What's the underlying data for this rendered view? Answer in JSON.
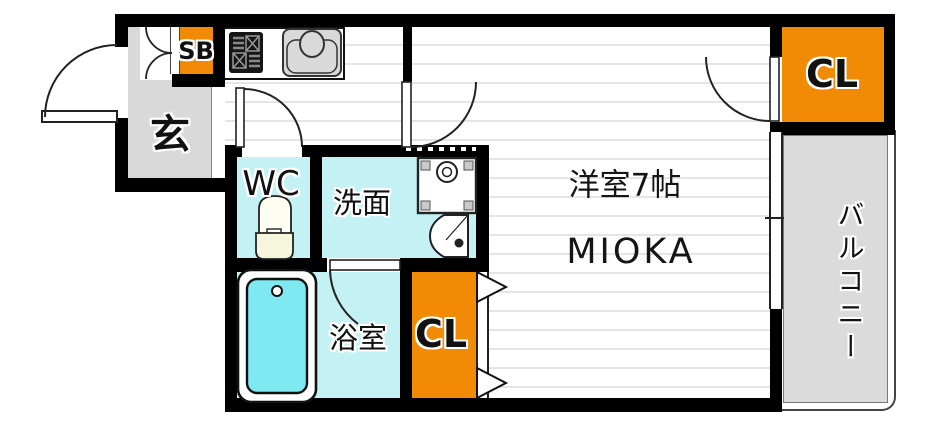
{
  "plan": {
    "building_name": "MIOKA",
    "rooms": {
      "genkan": {
        "label": "玄"
      },
      "shoe_box": {
        "label": "SB"
      },
      "wc": {
        "label": "WC"
      },
      "washroom": {
        "label": "洗面"
      },
      "bathroom": {
        "label": "浴室"
      },
      "closet_lower": {
        "label": "CL"
      },
      "closet_upper": {
        "label": "CL"
      },
      "western_room": {
        "label": "洋室7帖"
      },
      "balcony": {
        "label": "バルコニー"
      }
    },
    "fixtures": [
      "entrance-door-icon",
      "shoe-box-double-door-icon",
      "gas-stove-icon",
      "kitchen-sink-icon",
      "wc-door-icon",
      "toilet-icon",
      "room-door-icon",
      "washing-machine-pan-icon",
      "vanity-sink-icon",
      "bathroom-door-icon",
      "bathtub-icon",
      "folding-closet-door-icon",
      "closet-door-icon",
      "balcony-window-icon"
    ],
    "colors": {
      "wall": "#000000",
      "wet_room_cyan": "#c3f1f4",
      "closet_orange": "#f18a05",
      "entry_gray": "#d9d9d9",
      "balcony_gray": "#dbdbdb",
      "bathtub_cyan": "#7fe9f1",
      "floor_line": "#e5e5e5",
      "toilet_tank_cream": "#f6f6dc"
    }
  }
}
